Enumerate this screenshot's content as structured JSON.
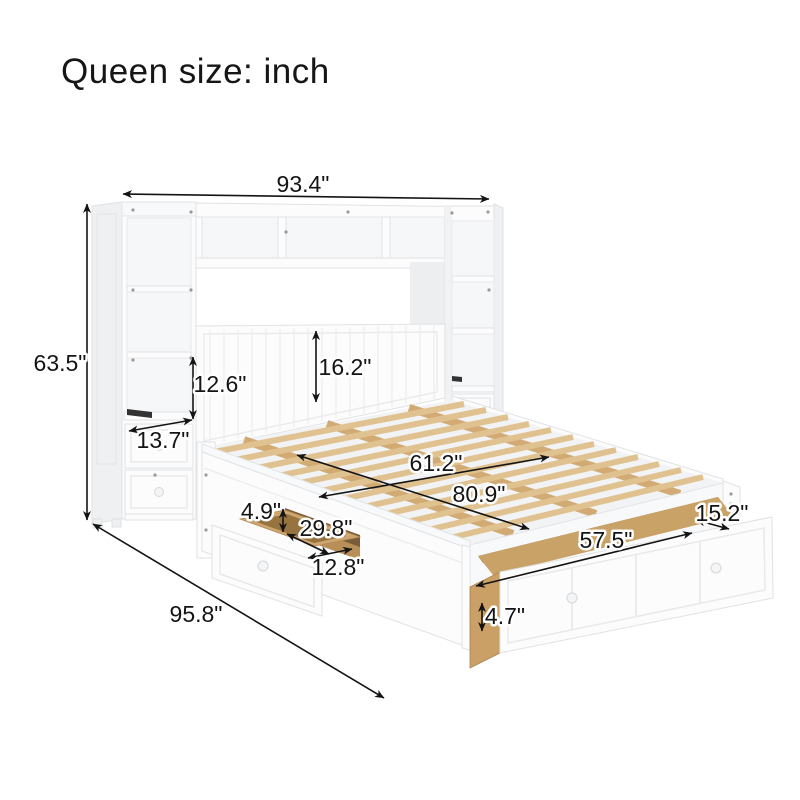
{
  "title": "Queen size: inch",
  "unit": "inch",
  "diagram": {
    "subject": "queen-storage-bed-with-bookcase-headboard",
    "colors": {
      "dimension_line": "#141414",
      "furniture_white": "#fcfcfd",
      "furniture_shadow": "#eef0f1",
      "slat_wood": "#e0c291",
      "drawer_wood": "#c9a268",
      "charging_slot": "#333333"
    },
    "dims": {
      "overall_width": "93.4\"",
      "overall_height": "63.5\"",
      "overall_length": "95.8\"",
      "shelf_opening_height": "12.6\"",
      "nightstand_depth": "13.7\"",
      "headboard_panel_height": "16.2\"",
      "bed_width": "61.2\"",
      "bed_length": "80.9\"",
      "side_drawer_height": "4.9\"",
      "side_drawer_length": "29.8\"",
      "side_drawer_width": "12.8\"",
      "foot_drawer_length": "57.5\"",
      "foot_drawer_width": "15.2\"",
      "foot_drawer_height": "4.7\""
    }
  }
}
